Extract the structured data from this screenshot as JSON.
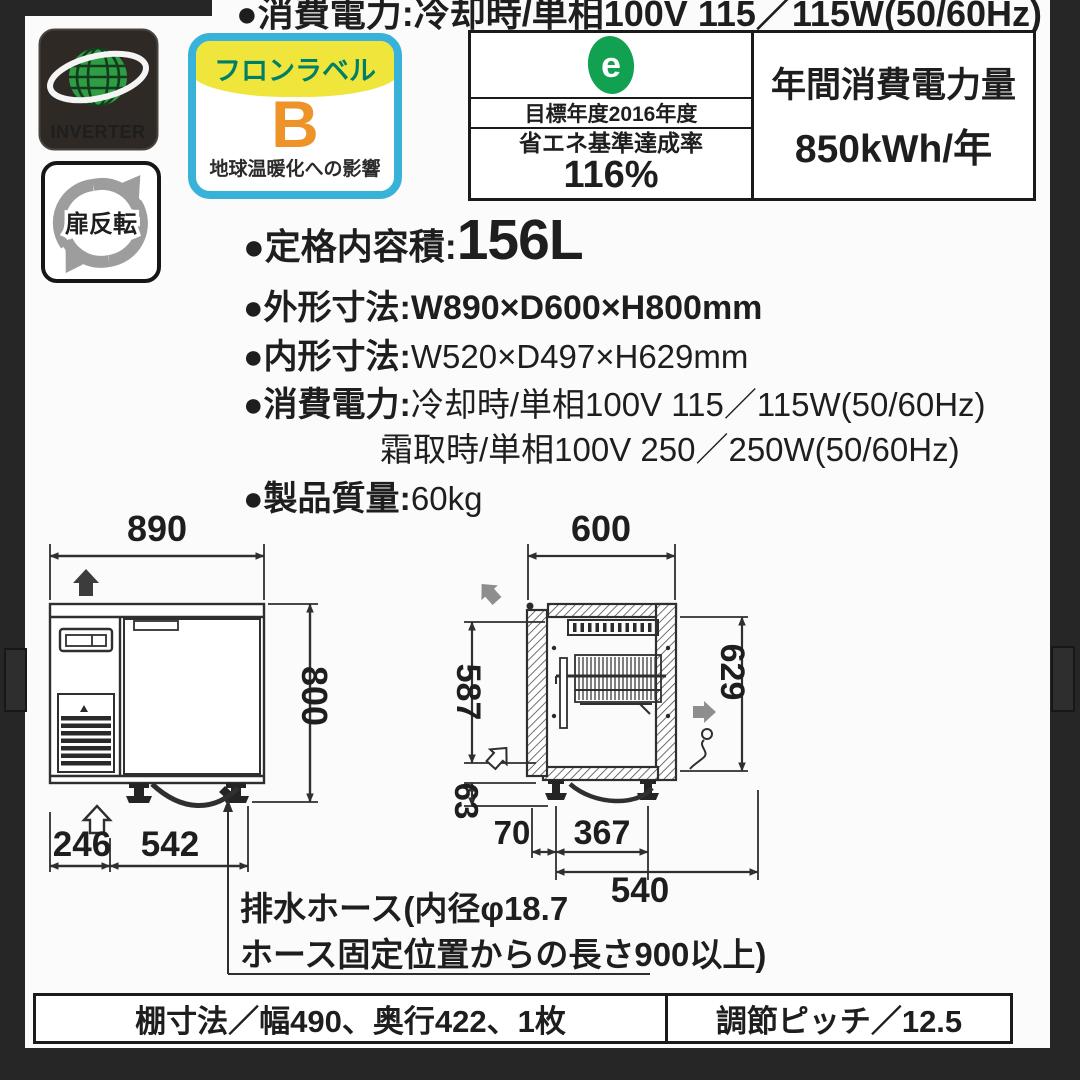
{
  "header": {
    "cut_line": "●消費電力:冷却時/単相100V 115／115W(50/60Hz)"
  },
  "badges": {
    "inverter": {
      "label": "INVERTER"
    },
    "door_reverse": {
      "label": "扉反転"
    },
    "freon": {
      "title": "フロンラベル",
      "grade": "B",
      "caption": "地球温暖化への影響"
    }
  },
  "energy_label": {
    "logo_letter": "e",
    "target_year": "目標年度2016年度",
    "standard_label": "省エネ基準達成率",
    "standard_value": "116%",
    "annual_label": "年間消費電力量",
    "annual_value": "850kWh/年"
  },
  "specs": {
    "capacity_label": "●定格内容積:",
    "capacity_value": "156L",
    "outer_label": "●外形寸法:",
    "outer_value": "W890×D600×H800mm",
    "inner_label": "●内形寸法:",
    "inner_value": "W520×D497×H629mm",
    "power_label": "●消費電力:",
    "power_cooling": "冷却時/単相100V 115／115W(50/60Hz)",
    "power_defrost": "霜取時/単相100V 250／250W(50/60Hz)",
    "weight_label": "●製品質量:",
    "weight_value": "60kg"
  },
  "drawings": {
    "front": {
      "width": "890",
      "height": "800",
      "left_offset": "246",
      "leg_span": "542"
    },
    "side": {
      "depth": "600",
      "upper_height": "587",
      "leg_height": "63",
      "inner_height": "629",
      "front_offset": "70",
      "leg_span": "367",
      "base_depth": "540"
    },
    "drain_note_line1": "排水ホース(内径φ18.7",
    "drain_note_line2": "ホース固定位置からの長さ900以上)"
  },
  "footer": {
    "shelf_spec": "棚寸法／幅490、奥行422、1枚",
    "pitch_spec": "調節ピッチ／12.5"
  },
  "colors": {
    "background": "#262626",
    "ink": "#1e1e1e",
    "freon_cyan": "#38b2d8",
    "freon_yellow": "#efe53b",
    "freon_green": "#007f68",
    "freon_orange": "#ee9327",
    "eco_green": "#12a150",
    "globe_green": "#2f9d43",
    "arrow_gray": "#8e8e8e"
  }
}
